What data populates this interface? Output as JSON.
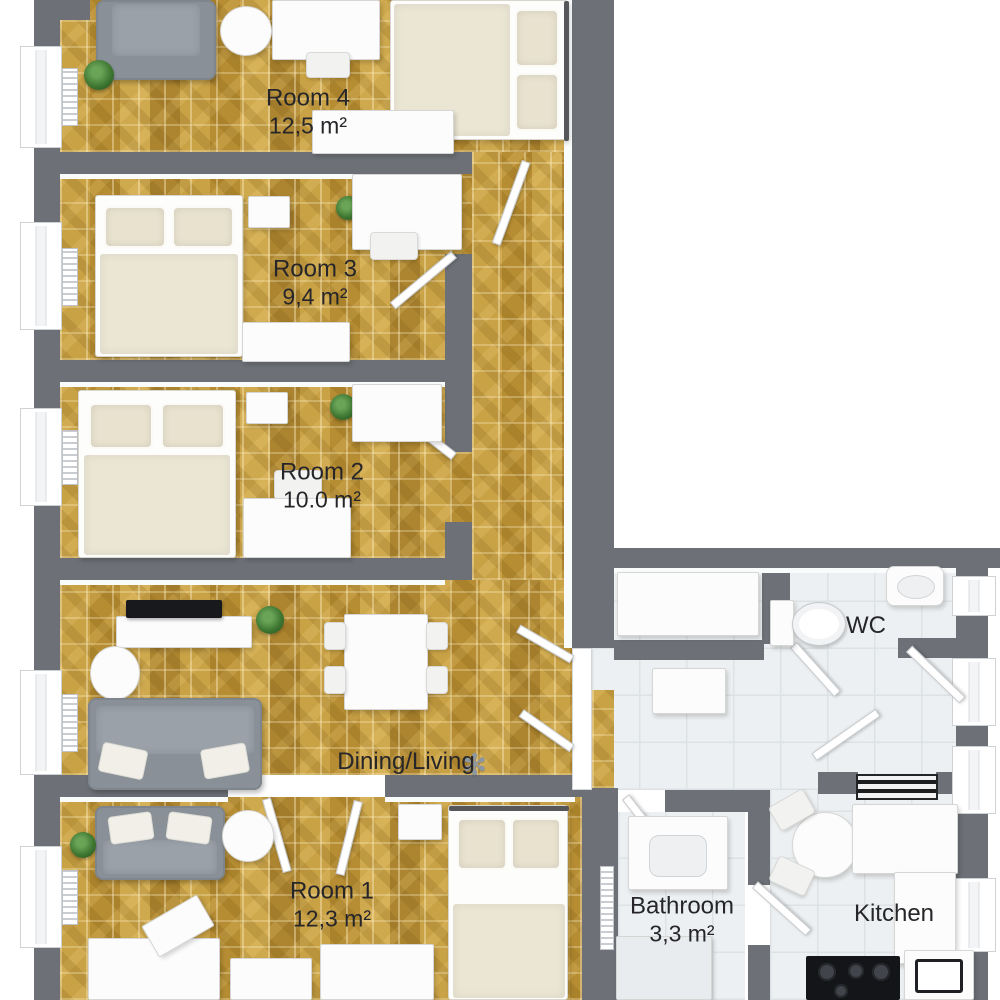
{
  "floorplan": {
    "rooms": {
      "room4": {
        "label": "Room 4",
        "area": "12,5 m²"
      },
      "room3": {
        "label": "Room 3",
        "area": "9,4 m²"
      },
      "room2": {
        "label": "Room 2",
        "area": "10.0 m²"
      },
      "dining": {
        "label": "Dining/Living",
        "area": ""
      },
      "room1": {
        "label": "Room 1",
        "area": "12,3 m²"
      },
      "wc": {
        "label": "WC",
        "area": ""
      },
      "bathroom": {
        "label": "Bathroom",
        "area": "3,3 m²"
      },
      "kitchen": {
        "label": "Kitchen",
        "area": ""
      }
    },
    "colors": {
      "wall": "#6d7177",
      "wood_floor": "#c09838",
      "tile_floor": "#edf0f2",
      "sofa_gray": "#899098",
      "bedding_beige": "#ebe5d4",
      "label_text": "#26262a"
    },
    "furniture": {
      "room4": [
        "armchair",
        "plant",
        "round-table",
        "desk",
        "chair",
        "double-bed",
        "sideboard"
      ],
      "room3": [
        "double-bed",
        "nightstand",
        "plant",
        "desk",
        "chair",
        "wardrobe"
      ],
      "room2": [
        "double-bed",
        "nightstand",
        "plant",
        "wardrobe",
        "desk",
        "chair"
      ],
      "dining_living": [
        "tv",
        "tv-board",
        "plant",
        "dining-table",
        "chairs",
        "coffee-table",
        "sofa",
        "pendant-lamp"
      ],
      "room1": [
        "sofa",
        "plant",
        "round-table",
        "nightstand",
        "bed",
        "desks"
      ],
      "hall": [
        "wardrobe",
        "cabinet",
        "radiator",
        "open-doors"
      ],
      "wc": [
        "toilet",
        "sink"
      ],
      "bathroom": [
        "vanity-sink",
        "towel-radiator",
        "shower"
      ],
      "kitchen": [
        "round-table",
        "chairs",
        "counters",
        "stove",
        "sink",
        "radiator"
      ]
    }
  }
}
